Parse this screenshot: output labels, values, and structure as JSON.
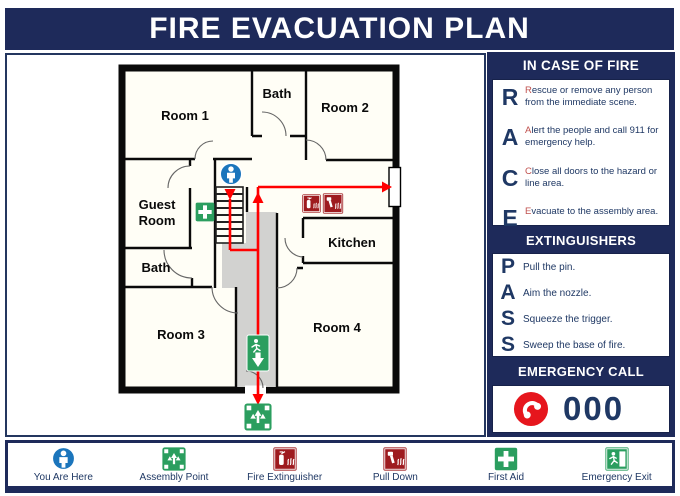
{
  "title": "FIRE EVACUATION PLAN",
  "floor_plan": {
    "rooms": {
      "room1": "Room 1",
      "bath_top": "Bath",
      "room2": "Room 2",
      "guest_line1": "Guest",
      "guest_line2": "Room",
      "kitchen": "Kitchen",
      "bath_left": "Bath",
      "room3": "Room 3",
      "room4": "Room 4"
    }
  },
  "sidebar": {
    "fire": {
      "header": "IN CASE OF FIRE",
      "items": [
        {
          "letter": "R",
          "lead": "R",
          "rest": "escue or remove any person from the immediate scene."
        },
        {
          "letter": "A",
          "lead": "A",
          "rest": "lert the people and call 911 for emergency help."
        },
        {
          "letter": "C",
          "lead": "C",
          "rest": "lose all doors to the hazard or line area."
        },
        {
          "letter": "E",
          "lead": "E",
          "rest": "vacuate to the assembly area."
        }
      ]
    },
    "ext": {
      "header": "EXTINGUISHERS",
      "items": [
        {
          "letter": "P",
          "text": "Pull the pin."
        },
        {
          "letter": "A",
          "text": "Aim the nozzle."
        },
        {
          "letter": "S",
          "text": "Squeeze the trigger."
        },
        {
          "letter": "S",
          "text": "Sweep the base of fire."
        }
      ]
    },
    "call": {
      "header": "EMERGENCY CALL",
      "number": "000"
    }
  },
  "legend": {
    "items": [
      {
        "label": "You Are Here"
      },
      {
        "label": "Assembly Point"
      },
      {
        "label": "Fire Extinguisher"
      },
      {
        "label": "Pull Down"
      },
      {
        "label": "First Aid"
      },
      {
        "label": "Emergency Exit"
      }
    ]
  },
  "colors": {
    "navy_bar": "#1E2A5A",
    "text_navy": "#1F3864",
    "lead_red": "#C0504D",
    "arrow_red": "#FF0000",
    "sign_maroon": "#9E1B1F",
    "sign_green": "#2B9E5F",
    "phone_red": "#E6161D",
    "here_blue": "#1B75BC",
    "corridor_gray": "#D2D2D0"
  }
}
